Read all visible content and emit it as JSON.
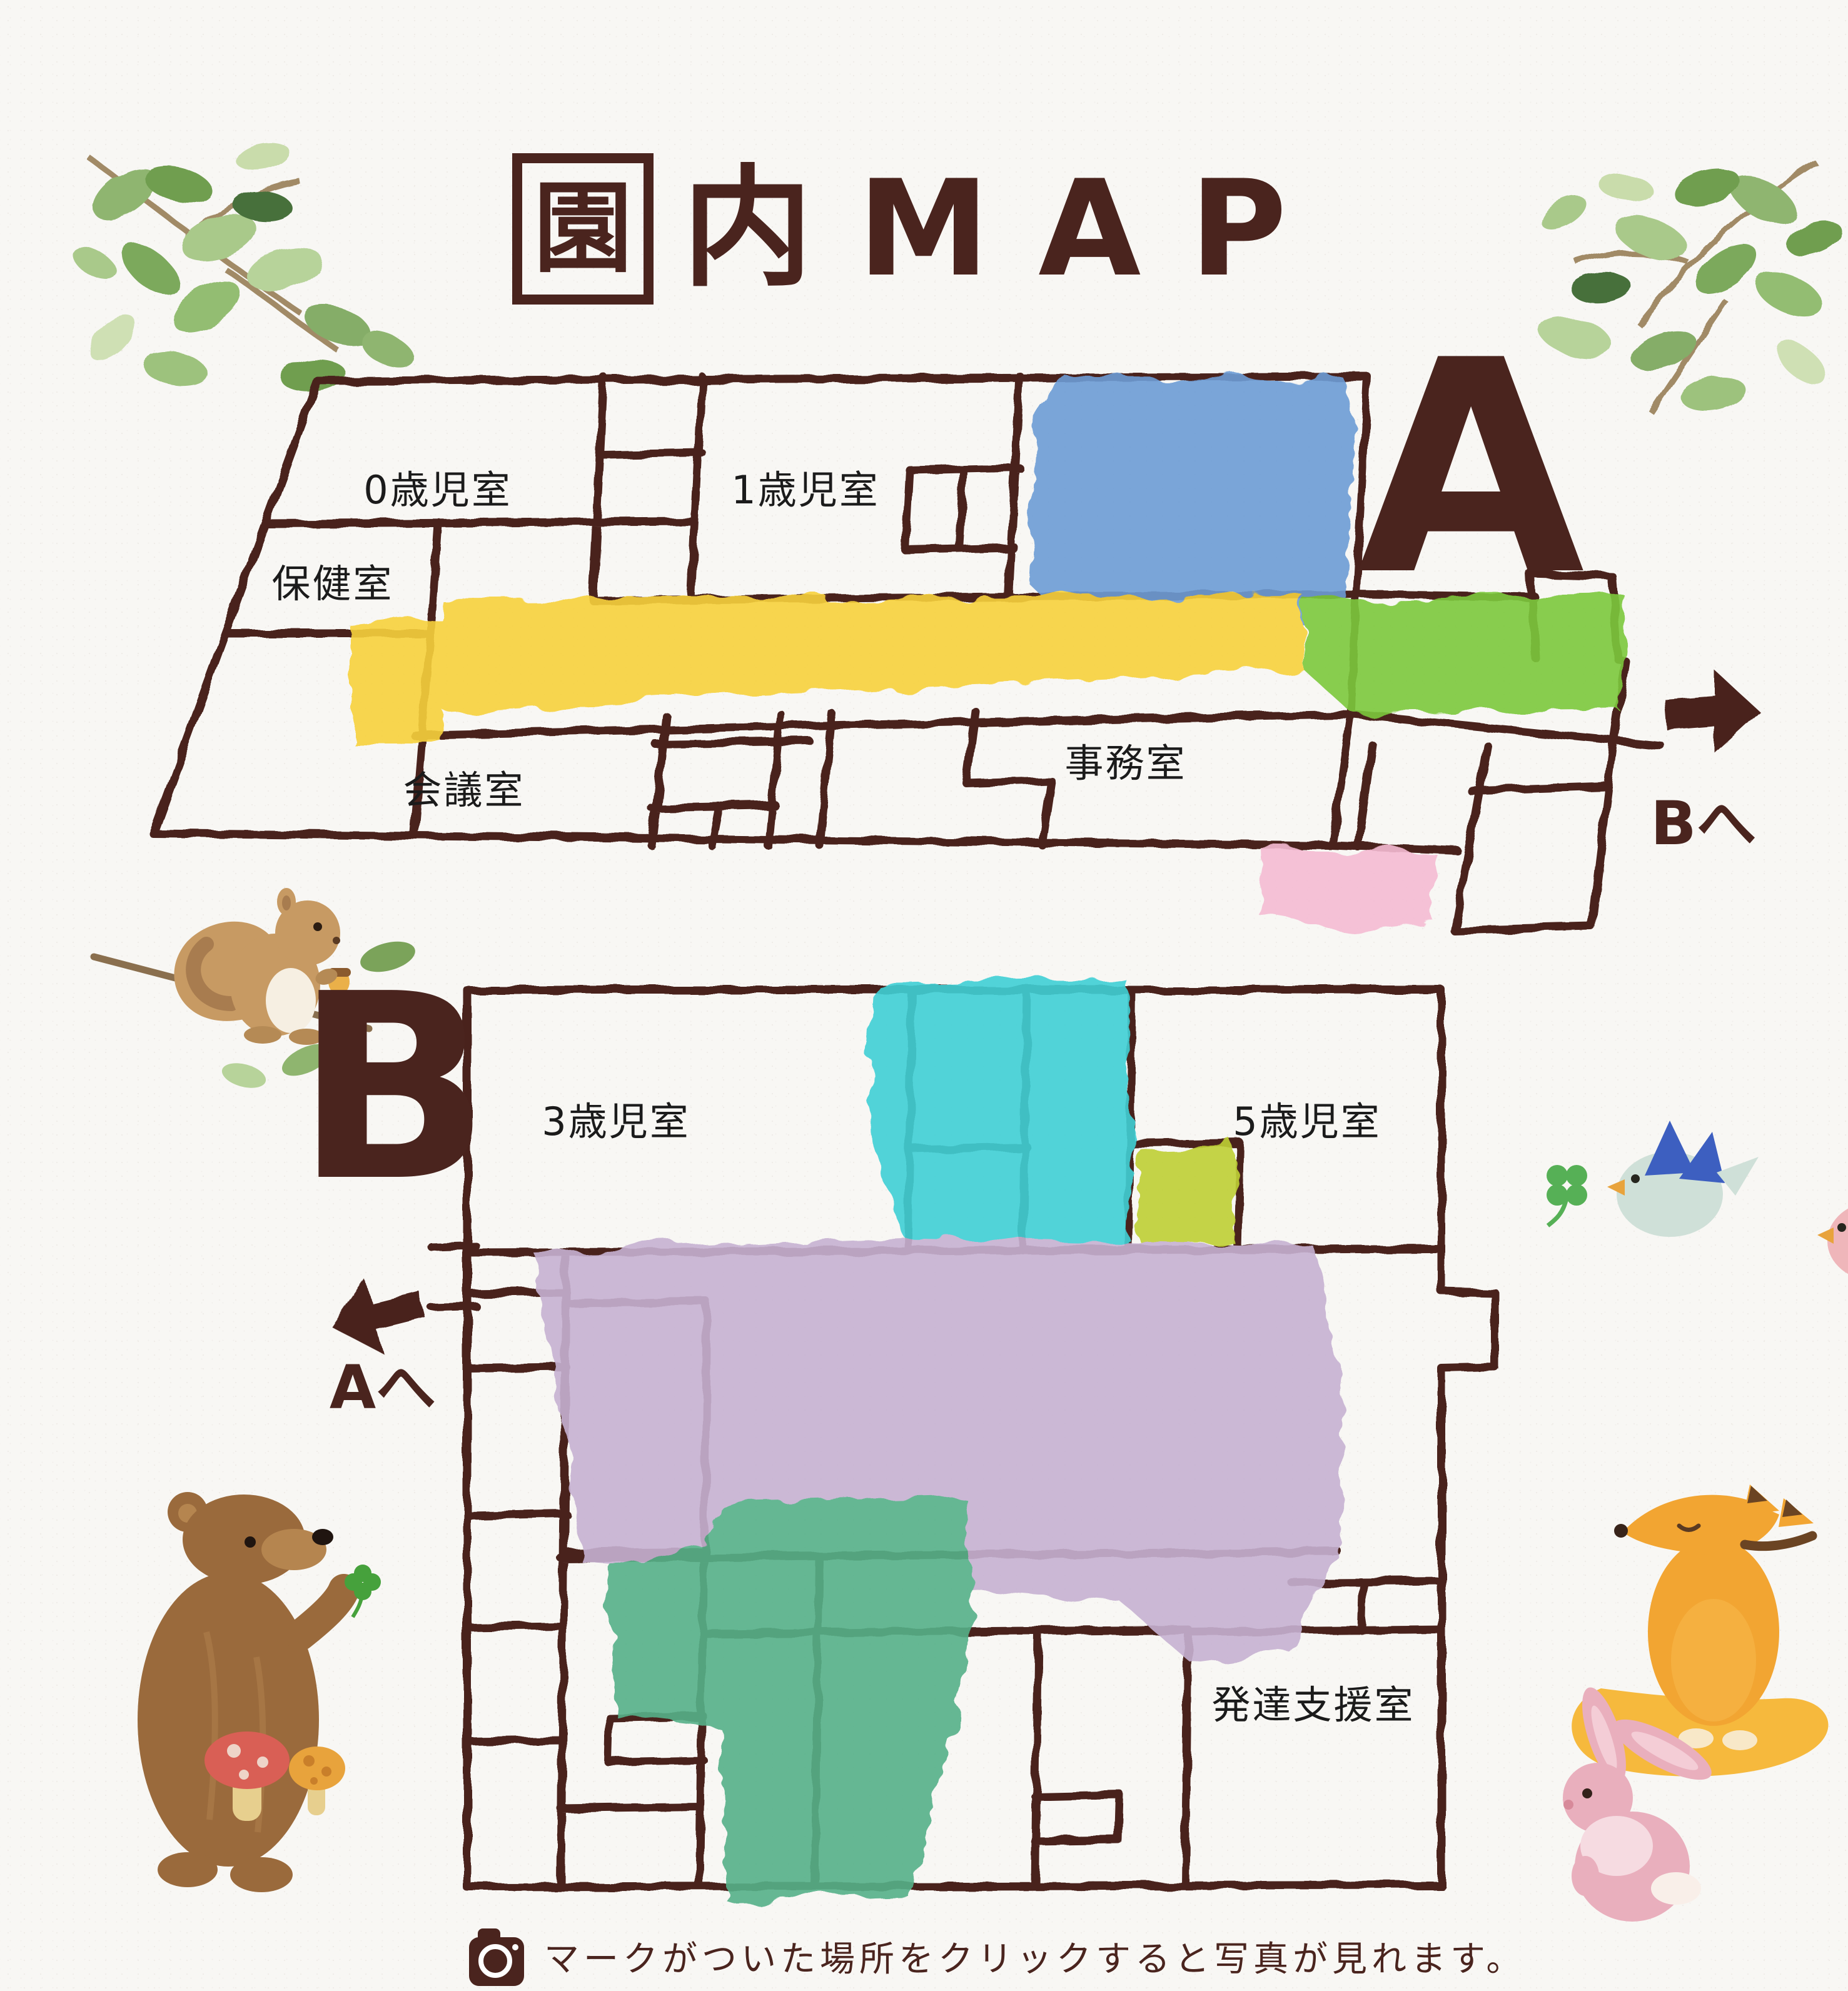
{
  "page": {
    "title": {
      "boxed_char": "園",
      "char2": "内",
      "latin": "MAP"
    },
    "caption": "マークがついた場所をクリックすると写真が見れます。"
  },
  "colors": {
    "ink": "#4a241e",
    "blue": "#6d9dd6",
    "yellow": "#f7d23e",
    "green": "#7cc93c",
    "pink": "#f5bcd3",
    "cyan": "#3fd0d6",
    "lime": "#bfd034",
    "purple": "#c7b2d2",
    "jade": "#57b189"
  },
  "map_a": {
    "section_label": "A",
    "rooms": {
      "room_0sai": "0歳児室",
      "room_1sai": "1歳児室",
      "hokenshitsu": "保健室",
      "kaigishitsu": "会議室",
      "jimushitsu": "事務室"
    },
    "nav": {
      "label": "Bへ"
    }
  },
  "map_b": {
    "section_label": "B",
    "rooms": {
      "room_3sai": "3歳児室",
      "room_5sai": "5歳児室",
      "hattatsu_shien": "発達支援室"
    },
    "nav": {
      "label": "Aへ"
    }
  },
  "icons": {
    "caption_icon": "camera-icon",
    "map_a_nav_icon": "arrow-right-icon",
    "map_b_nav_icon": "arrow-left-icon"
  },
  "decorations": [
    "leaves-branch-top-left",
    "leaves-branch-top-right",
    "squirrel",
    "bear",
    "mushrooms",
    "clover",
    "birds",
    "fox",
    "rabbit"
  ]
}
